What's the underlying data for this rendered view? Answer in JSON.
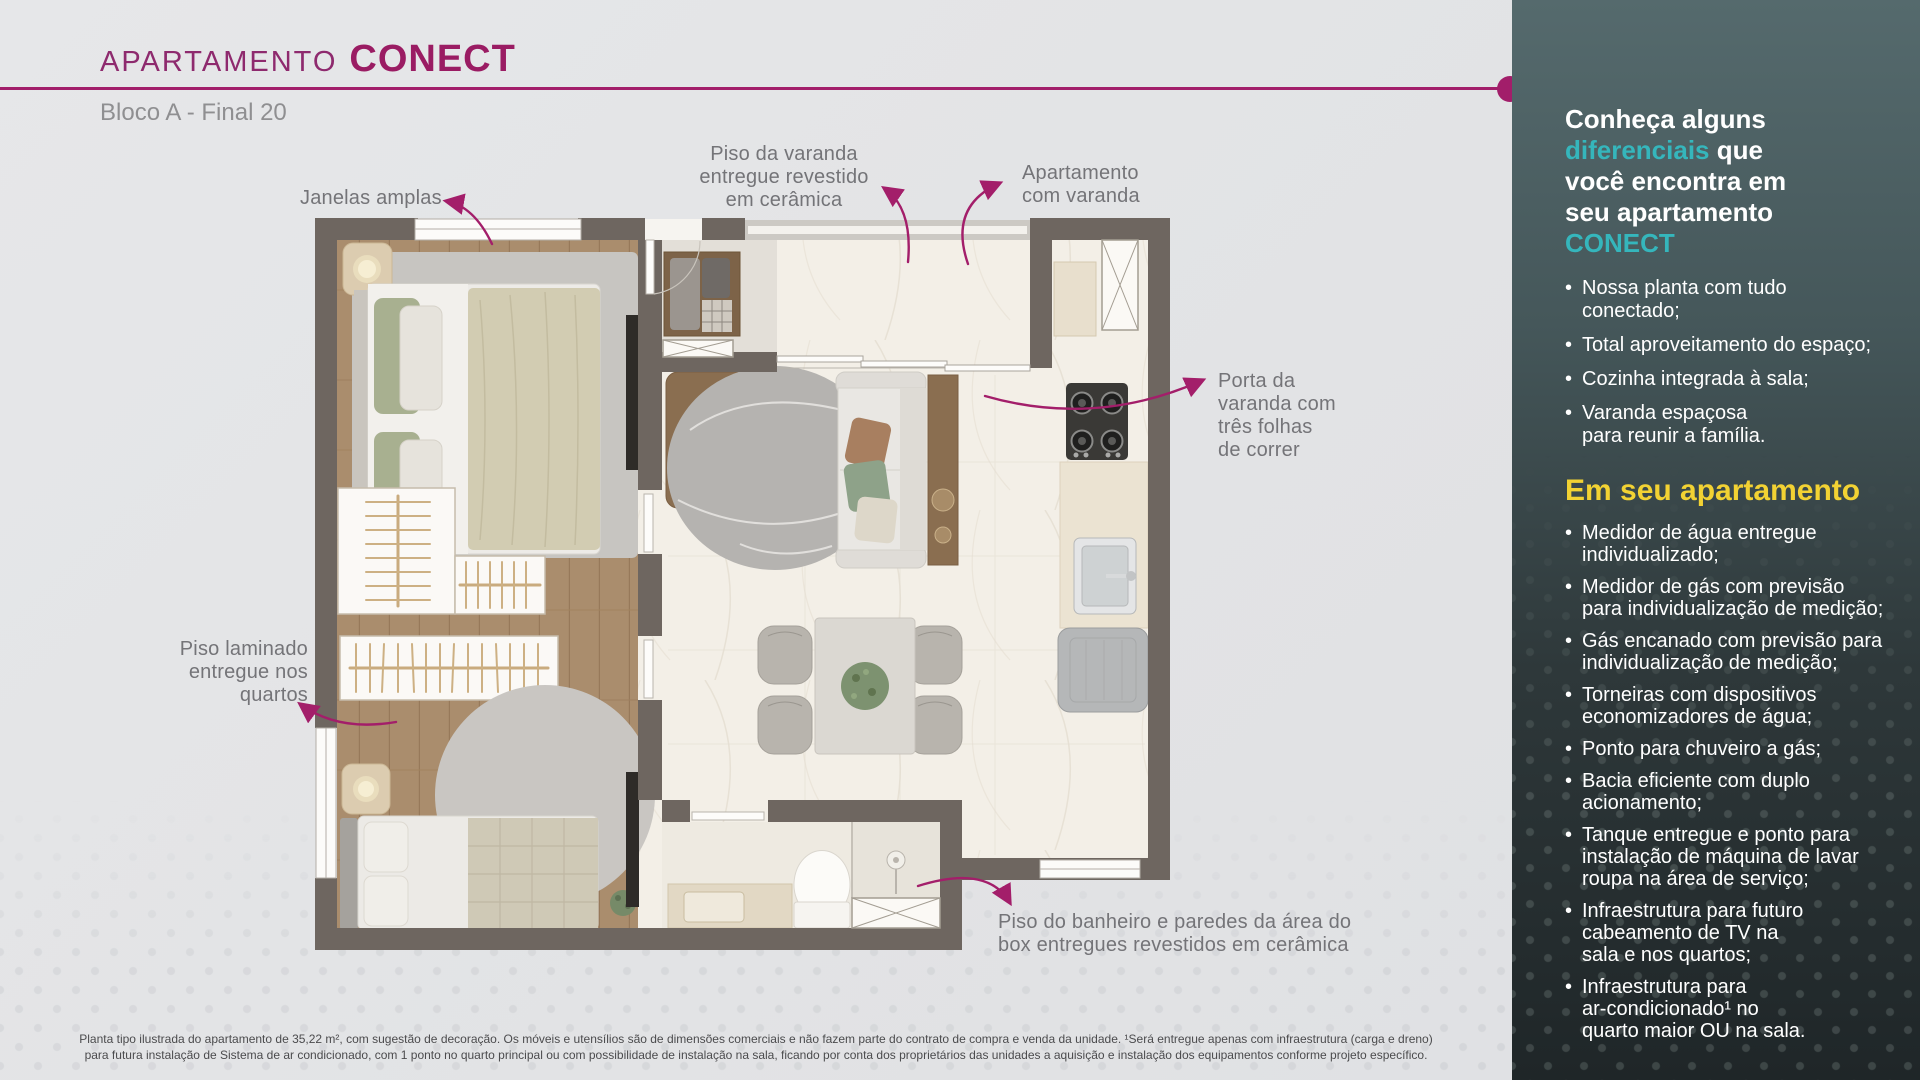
{
  "header": {
    "brand_prefix": "APARTAMENTO",
    "brand_name": "CONECT",
    "subtitle": "Bloco A - Final 20"
  },
  "plan": {
    "annotations": {
      "janelas": "Janelas amplas",
      "piso_varanda": "Piso da varanda\nentregue revestido\nem cerâmica",
      "apartamento_varanda": "Apartamento\ncom varanda",
      "porta_varanda": "Porta da\nvaranda com\ntrês folhas\nde correr",
      "piso_laminado": "Piso laminado\nentregue nos\nquartos",
      "piso_banheiro": "Piso do banheiro e paredes da área do\nbox entregues revestidos em cerâmica"
    }
  },
  "sidebar": {
    "heading": {
      "part1": "Conheça alguns\n",
      "accent1": "diferenciais",
      "part2": " que\nvocê encontra em\nseu apartamento\n",
      "accent2": "CONECT"
    },
    "differentials": [
      "Nossa planta com tudo\nconectado;",
      "Total aproveitamento do espaço;",
      "Cozinha integrada à sala;",
      "Varanda espaçosa\npara reunir a família."
    ],
    "section_title": "Em seu apartamento",
    "features": [
      "Medidor de água entregue\nindividualizado;",
      "Medidor de gás com previsão\npara individualização de medição;",
      "Gás encanado com previsão para\nindividualização de medição;",
      "Torneiras com dispositivos\neconomizadores de água;",
      "Ponto para chuveiro a gás;",
      "Bacia eficiente com duplo\nacionamento;",
      "Tanque entregue e ponto para\ninstalação de máquina de lavar\nroupa na área de serviço;",
      "Infraestrutura para futuro\ncabeamento de TV na\nsala e nos quartos;",
      "Infraestrutura para\nar-condicionado¹ no\nquarto maior OU na sala."
    ]
  },
  "disclaimer": "Planta tipo ilustrada do apartamento de 35,22 m², com sugestão de decoração. Os móveis e utensílios são de dimensões comerciais e não fazem parte do contrato de compra e venda da unidade. ¹Será entregue apenas com infraestrutura (carga e dreno)\npara futura instalação de Sistema de ar condicionado, com 1 ponto no quarto principal ou com possibilidade de instalação na sala, ficando por conta dos proprietários das unidades a aquisição e instalação dos equipamentos conforme projeto específico.",
  "colors": {
    "magenta": "#a21e6a",
    "teal": "#35b6bc",
    "yellow": "#f2d233",
    "sidebar_top": "#556a6d",
    "sidebar_bottom": "#1f2628",
    "wall": "#6e6660"
  }
}
